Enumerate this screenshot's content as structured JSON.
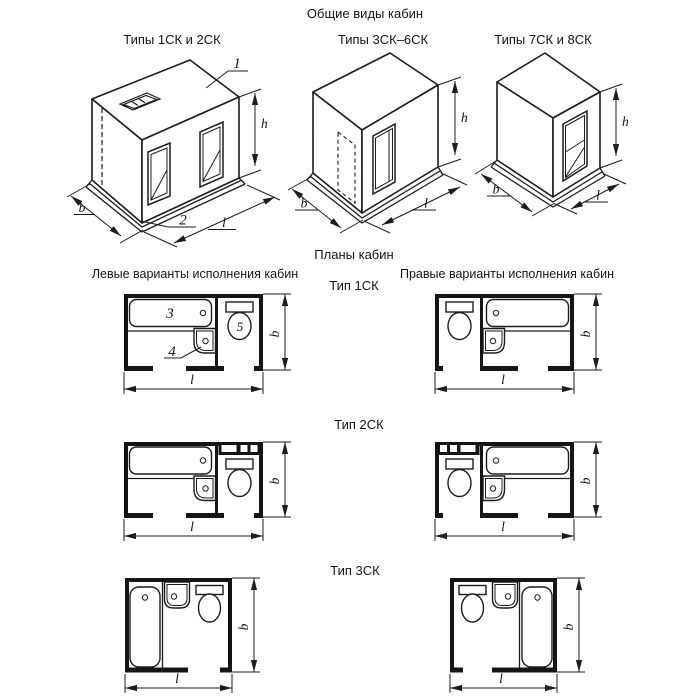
{
  "titles": {
    "general_views": "Общие виды кабин",
    "iso1_caption": "Типы 1СК и 2СК",
    "iso2_caption": "Типы 3СК–6СК",
    "iso3_caption": "Типы 7СК и 8СК",
    "plans": "Планы кабин",
    "left_variants": "Левые варианты исполнения кабин",
    "right_variants": "Правые варианты исполнения кабин",
    "type1": "Тип 1СК",
    "type2": "Тип 2СК",
    "type3": "Тип 3СК"
  },
  "dims": {
    "h": "h",
    "b": "b",
    "l": "l"
  },
  "callouts": {
    "c1": "1",
    "c2": "2",
    "c3": "3",
    "c4": "4",
    "c5": "5"
  },
  "colors": {
    "line": "#1c1c1c",
    "background": "#ffffff"
  }
}
